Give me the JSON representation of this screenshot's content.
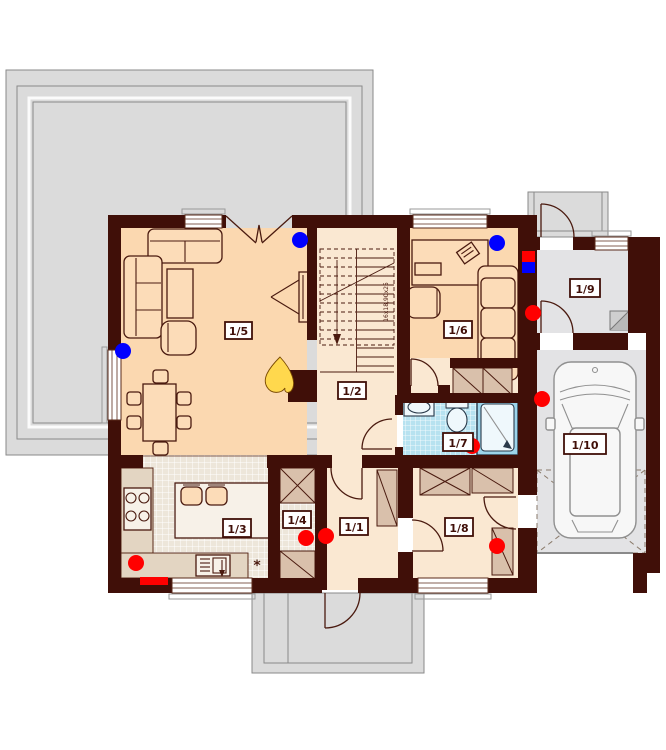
{
  "floorplan": {
    "room_labels": {
      "1/1": "1/1",
      "1/2": "1/2",
      "1/3": "1/3",
      "1/4": "1/4",
      "1/5": "1/5",
      "1/6": "1/6",
      "1/7": "1/7",
      "1/8": "1/8",
      "1/9": "1/9",
      "1/10": "1/10"
    },
    "stair_dimension_note": "16x18,90x25",
    "appliance_symbol": "*",
    "colors": {
      "wall": "#400F08",
      "floor_warm": "#FBD8B0",
      "floor_light": "#FAE8D2",
      "tile_floor": "#EDE6DA",
      "bath_tile": "#B7E2F0",
      "terrace_gray": "#DBDBDB",
      "concrete_gray": "#E3E3E5",
      "marker_red": "#FF0000",
      "marker_blue": "#0000FF",
      "flame_yellow": "#FFD84D",
      "wardrobe_tan": "#D9C0AB"
    }
  }
}
